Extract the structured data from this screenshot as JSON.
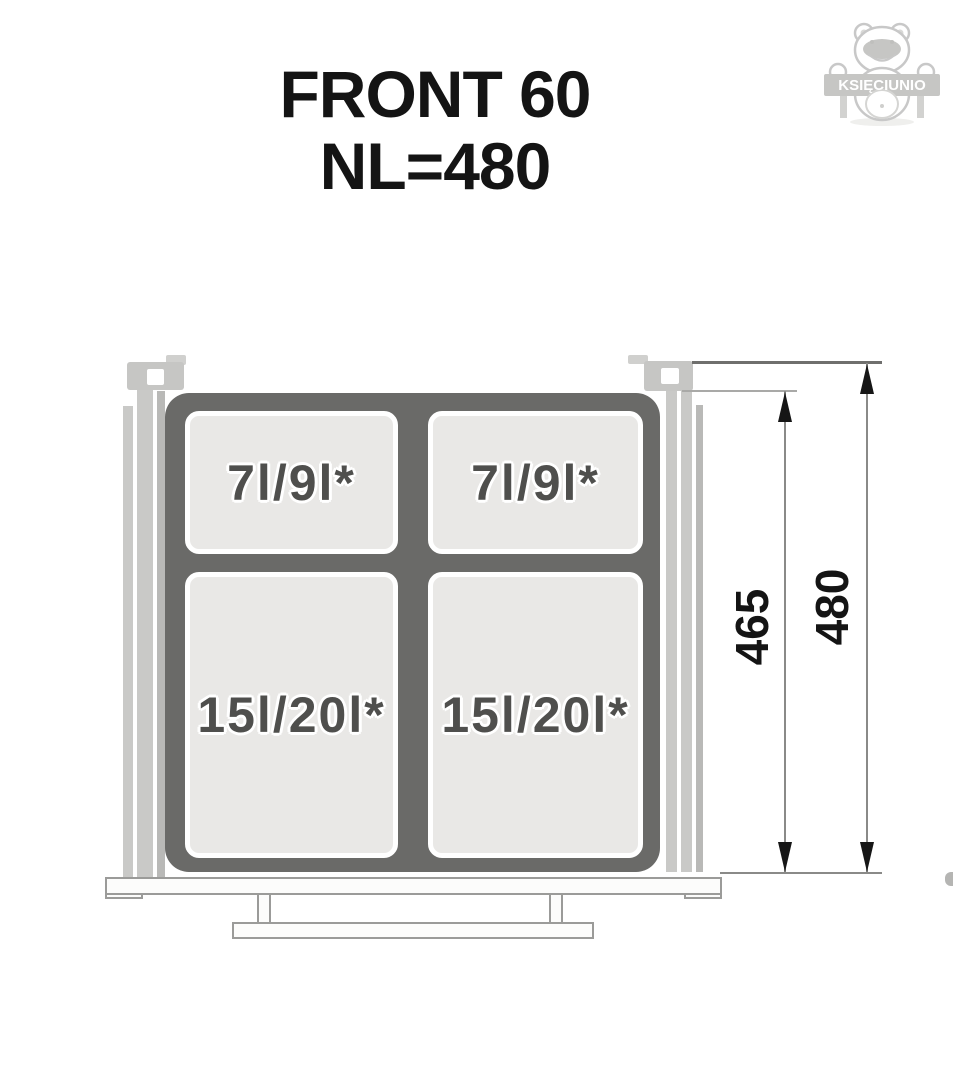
{
  "title": {
    "line1": "FRONT 60",
    "line2": "NL=480"
  },
  "watermark": {
    "label": "KSIĘCIUNIO"
  },
  "diagram": {
    "description": "waste-bin-drawer-top-view",
    "compartments": [
      {
        "id": "top-left",
        "label": "7l/9l*"
      },
      {
        "id": "top-right",
        "label": "7l/9l*"
      },
      {
        "id": "bottom-left",
        "label": "15l/20l*"
      },
      {
        "id": "bottom-right",
        "label": "15l/20l*"
      }
    ],
    "dimensions": [
      {
        "id": "inner-height",
        "value": "465"
      },
      {
        "id": "overall-height",
        "value": "480"
      }
    ],
    "colors": {
      "frame": "#6a6a68",
      "compartment_fill": "#e9e8e6",
      "compartment_text": "#4f4f4d",
      "rail": "#c9c9c7",
      "hardware_outline": "#9b9b99",
      "dimension_line": "#8a8a88",
      "arrow": "#161616",
      "watermark": "#c8c8c8"
    }
  }
}
